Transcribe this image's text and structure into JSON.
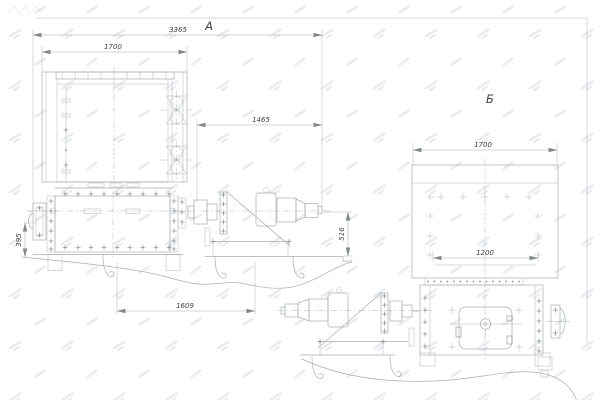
{
  "drawing": {
    "view_a": {
      "label": "А",
      "dimensions": {
        "overall_length": "3365",
        "screen_width": "1700",
        "drive_length": "1465",
        "bearing_offset": "395",
        "drive_height": "516",
        "foundation_span": "1609"
      }
    },
    "view_b": {
      "label": "Б",
      "dimensions": {
        "body_width": "1700",
        "flange_span": "1200"
      }
    },
    "colors": {
      "line": "#a8aeb3",
      "detail": "#82898e",
      "text": "#3d4145",
      "background": "#ffffff",
      "watermark": "#e9ebee"
    }
  }
}
